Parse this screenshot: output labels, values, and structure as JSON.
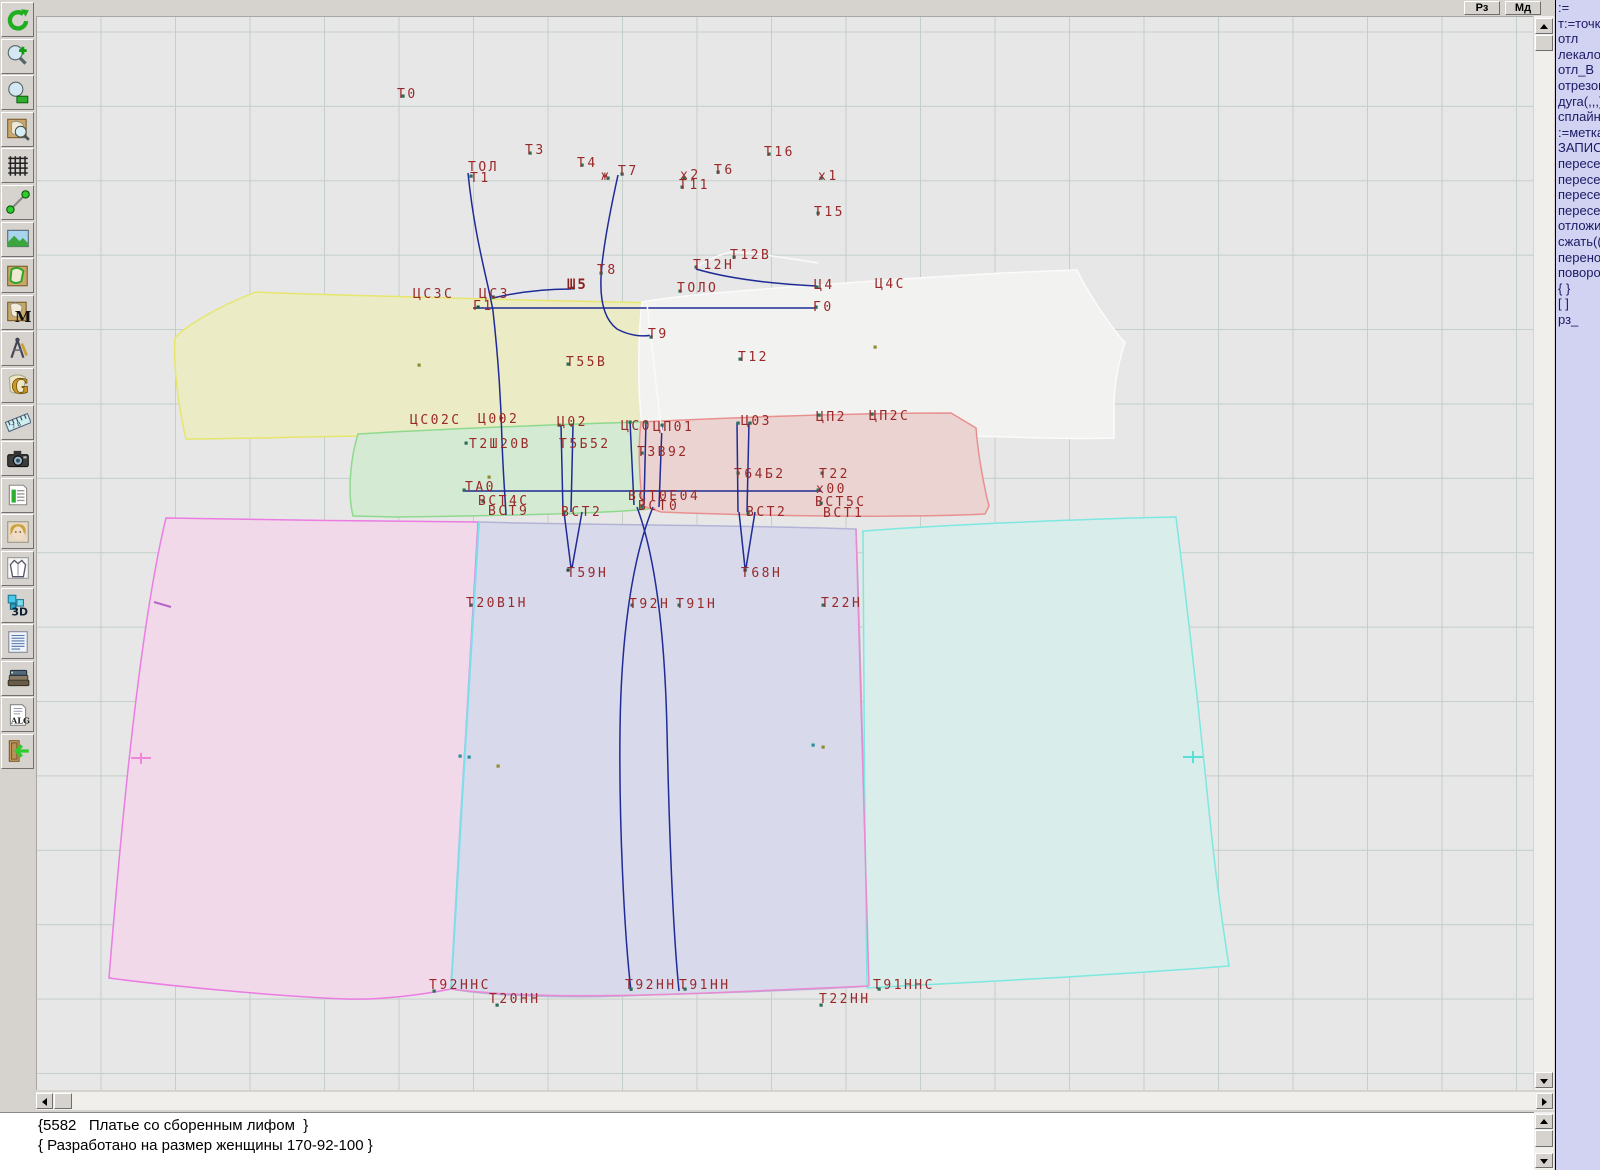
{
  "window": {
    "buttons": [
      {
        "label": "Рз"
      },
      {
        "label": "Мд"
      }
    ]
  },
  "right_panel": {
    "lines": [
      ":=",
      "т:=точка",
      "отл",
      "лекало",
      "отл_В",
      "отрезок",
      "дуга(,,,)",
      "сплайн_",
      ":=метка",
      "ЗАПИСА",
      "пересеч",
      "пересеч",
      "пересеч",
      "пересеч",
      "отложит",
      "сжать(()",
      "перенос",
      "поворот",
      "{ }",
      "[ ]",
      "рз_"
    ]
  },
  "status": {
    "line1": "{5582   Платье со сборенным лифом  }",
    "line2": "{ Разработано на размер женщины 170-92-100 }"
  },
  "toolbar": {
    "buttons": [
      {
        "name": "refresh",
        "icon": "refresh"
      },
      {
        "name": "zoom-in",
        "icon": "zoomin"
      },
      {
        "name": "zoom-out",
        "icon": "zoomout"
      },
      {
        "name": "piece-preview",
        "icon": "preview"
      },
      {
        "name": "grid",
        "icon": "grid"
      },
      {
        "name": "measure-line",
        "icon": "measure"
      },
      {
        "name": "image",
        "icon": "image"
      },
      {
        "name": "pattern-piece",
        "icon": "piece"
      },
      {
        "name": "pattern-m",
        "icon": "mletter"
      },
      {
        "name": "drafting-compass",
        "icon": "compass"
      },
      {
        "name": "letter-g",
        "icon": "gletter"
      },
      {
        "name": "ruler",
        "icon": "ruler"
      },
      {
        "name": "camera",
        "icon": "camera"
      },
      {
        "name": "size-table",
        "icon": "table"
      },
      {
        "name": "model-photo",
        "icon": "photo"
      },
      {
        "name": "garment-sketch",
        "icon": "garment"
      },
      {
        "name": "view-3d",
        "icon": "threed"
      },
      {
        "name": "text-list",
        "icon": "textlist"
      },
      {
        "name": "books",
        "icon": "books"
      },
      {
        "name": "alg-document",
        "icon": "alg"
      },
      {
        "name": "exit",
        "icon": "exit"
      }
    ]
  },
  "canvas": {
    "pieces": [
      {
        "name": "back-bodice-yellow",
        "fill": "#ebebc6",
        "stroke": "#e6e66e",
        "d": "M255,291 C290,293 380,295 450,297 C520,299 600,301 655,302 C658,330 655,380 648,427 L640,433 C580,436 460,434 360,435 C290,436 230,438 185,438 C178,410 172,365 174,337 C182,327 215,306 255,291 Z"
      },
      {
        "name": "front-bodice-white",
        "fill": "#f2f2f0",
        "stroke": "#fbfbfb",
        "d": "M641,301 C680,294 760,288 830,283 C910,277 1010,271 1076,269 C1085,288 1105,320 1124,342 C1118,358 1114,380 1113,400 L1113,437 C1060,439 960,434 860,432 C770,430 690,428 642,431 C637,400 636,345 641,301 Z"
      },
      {
        "name": "midriff-left-green",
        "fill": "#d5ead2",
        "stroke": "#8fd98f",
        "d": "M357,433 C420,429 540,424 640,421 L662,424 C660,455 653,495 648,508 C600,513 480,515 395,516 L352,515 C346,490 350,455 357,433 Z"
      },
      {
        "name": "midriff-right-red",
        "fill": "#ebd3d1",
        "stroke": "#e89090",
        "d": "M640,421 C720,417 850,412 950,412 L975,427 C977,455 984,490 988,505 L984,513 C900,517 760,515 660,511 L642,505 C638,478 637,445 640,421 Z"
      },
      {
        "name": "skirt-left-magenta",
        "fill": "#f2d9ea",
        "stroke": "#ea7ce2",
        "d": "M165,517 C260,519 380,520 477,521 L450,988 C420,994 380,999 345,998 C270,995 160,984 108,977 C115,890 135,640 165,517 Z"
      },
      {
        "name": "skirt-center-blue",
        "fill": "#d9d9ec",
        "stroke": "#b3b3d6",
        "d": "M478,521 C580,524 740,524 855,528 C860,650 864,850 868,985 C800,990 700,992 620,995 C560,997 490,995 450,988 C458,830 470,650 478,521 Z"
      },
      {
        "name": "skirt-right-cyan",
        "fill": "#d9edeb",
        "stroke": "#7ce8e0",
        "d": "M862,530 C940,524 1080,518 1175,516 C1183,580 1197,700 1207,800 C1215,880 1224,940 1228,965 C1140,972 1000,980 900,985 L866,987 C864,850 862,650 862,530 Z"
      }
    ],
    "lines": [
      {
        "d": "M478,521 C470,650 458,850 450,988",
        "stroke": "#7ce0ea",
        "w": 2
      },
      {
        "d": "M855,528 C861,700 866,870 868,985",
        "stroke": "#e98ad2",
        "w": 1.5
      },
      {
        "d": "M450,988 C520,997 620,996 730,991 C780,989 830,987 868,985",
        "stroke": "#e98ad2",
        "w": 1.5
      },
      {
        "d": "M472,307 L816,307",
        "stroke": "#1f2b96",
        "w": 1.5
      },
      {
        "d": "M462,490 L820,490",
        "stroke": "#1f2b96",
        "w": 1.5
      },
      {
        "d": "M467,172 C474,240 487,280 492,310 C497,355 500,400 501,440 C502,470 504,495 505,514",
        "stroke": "#1f2b96",
        "w": 1.5
      },
      {
        "d": "M617,174 C608,215 601,252 600,277 C599,302 604,319 616,328 C629,335 642,336 651,334",
        "stroke": "#1f2b96",
        "w": 1.5
      },
      {
        "d": "M492,297 C517,291 545,288 570,288",
        "stroke": "#1f2b96",
        "w": 1.5
      },
      {
        "d": "M695,268 C732,279 776,283 816,285",
        "stroke": "#1f2b96",
        "w": 1.5
      },
      {
        "d": "M560,424 L562,511 M572,424 L570,511 M563,511 L570,567 M581,511 L571,567",
        "stroke": "#1f2b96",
        "w": 1.5
      },
      {
        "d": "M736,421 L737,511 M748,421 L746,511 M738,511 L744,567 M754,511 L745,567",
        "stroke": "#1f2b96",
        "w": 1.5
      },
      {
        "d": "M629,420 L633,504 M645,420 L643,504 M661,424 L658,506",
        "stroke": "#1f2b96",
        "w": 1.5
      },
      {
        "d": "M652,506 C630,560 620,640 619,730 C618,820 623,930 630,990",
        "stroke": "#1f2b96",
        "w": 1.5
      },
      {
        "d": "M636,506 C656,560 664,640 666,730 C668,820 672,930 678,990",
        "stroke": "#1f2b96",
        "w": 1.5
      },
      {
        "d": "M646,303 C651,345 656,395 661,432",
        "stroke": "#fafafa",
        "w": 1.5
      },
      {
        "d": "M694,267 C706,259 719,253 731,251 C762,253 792,258 817,262",
        "stroke": "#fafafa",
        "w": 1.5
      },
      {
        "d": "M153,601 L170,606",
        "stroke": "#b565c8",
        "w": 2
      },
      {
        "d": "M130,757 L150,757 M140,752 L140,763",
        "stroke": "#ef86d8",
        "w": 2
      },
      {
        "d": "M1182,756 L1202,756 M1192,750 L1192,762",
        "stroke": "#5adfd6",
        "w": 2
      }
    ],
    "labels": [
      {
        "t": "Т0",
        "x": 396,
        "y": 87
      },
      {
        "t": "Т3",
        "x": 524,
        "y": 143
      },
      {
        "t": "Т4",
        "x": 576,
        "y": 156
      },
      {
        "t": "ТОЛ",
        "x": 467,
        "y": 160
      },
      {
        "t": "Т1",
        "x": 469,
        "y": 171
      },
      {
        "t": "ж",
        "x": 600,
        "y": 169
      },
      {
        "t": "Т7",
        "x": 617,
        "y": 164
      },
      {
        "t": "х2",
        "x": 679,
        "y": 168
      },
      {
        "t": "Т11",
        "x": 678,
        "y": 178
      },
      {
        "t": "Т6",
        "x": 713,
        "y": 163
      },
      {
        "t": "Т16",
        "x": 763,
        "y": 145
      },
      {
        "t": "х1",
        "x": 817,
        "y": 169
      },
      {
        "t": "Т15",
        "x": 813,
        "y": 205
      },
      {
        "t": "Т12В",
        "x": 729,
        "y": 248
      },
      {
        "t": "Т12Н",
        "x": 692,
        "y": 258
      },
      {
        "t": "Т8",
        "x": 596,
        "y": 263
      },
      {
        "t": "Ш5",
        "x": 566,
        "y": 278,
        "b": 1
      },
      {
        "t": "ЦСЗС",
        "x": 412,
        "y": 287
      },
      {
        "t": "ЦСЗ",
        "x": 478,
        "y": 287
      },
      {
        "t": "Г1",
        "x": 472,
        "y": 299
      },
      {
        "t": "ТОЛО",
        "x": 676,
        "y": 281
      },
      {
        "t": "Ц4",
        "x": 813,
        "y": 278
      },
      {
        "t": "Ц4С",
        "x": 874,
        "y": 277
      },
      {
        "t": "Г0",
        "x": 812,
        "y": 300
      },
      {
        "t": "Т9",
        "x": 647,
        "y": 327
      },
      {
        "t": "Т12",
        "x": 737,
        "y": 350
      },
      {
        "t": "Т55В",
        "x": 565,
        "y": 355
      },
      {
        "t": "ЦС02С",
        "x": 409,
        "y": 413
      },
      {
        "t": "Ц002",
        "x": 477,
        "y": 412
      },
      {
        "t": "Ц02",
        "x": 556,
        "y": 415
      },
      {
        "t": "ЦС0",
        "x": 620,
        "y": 419
      },
      {
        "t": "ЦП01",
        "x": 652,
        "y": 420
      },
      {
        "t": "Ц03",
        "x": 740,
        "y": 414
      },
      {
        "t": "ЦП2",
        "x": 815,
        "y": 410
      },
      {
        "t": "ЦП2С",
        "x": 868,
        "y": 409
      },
      {
        "t": "Т2Ш20В",
        "x": 468,
        "y": 437
      },
      {
        "t": "Т5Б52",
        "x": 558,
        "y": 437
      },
      {
        "t": "ТЗВ92",
        "x": 636,
        "y": 445
      },
      {
        "t": "Т64Б2",
        "x": 733,
        "y": 467
      },
      {
        "t": "Т22",
        "x": 818,
        "y": 467
      },
      {
        "t": "х00",
        "x": 815,
        "y": 482
      },
      {
        "t": "ТА0",
        "x": 464,
        "y": 480
      },
      {
        "t": "ВСТ4С",
        "x": 477,
        "y": 494
      },
      {
        "t": "ВСТ9",
        "x": 487,
        "y": 504
      },
      {
        "t": "ВСТ2",
        "x": 560,
        "y": 505
      },
      {
        "t": "ВСТ0Е04",
        "x": 627,
        "y": 489
      },
      {
        "t": "ВСТ0",
        "x": 637,
        "y": 499
      },
      {
        "t": "ВСТ2",
        "x": 745,
        "y": 505
      },
      {
        "t": "ВСТ5С",
        "x": 814,
        "y": 495
      },
      {
        "t": "ВСТ1",
        "x": 822,
        "y": 506
      },
      {
        "t": "Т59Н",
        "x": 566,
        "y": 566
      },
      {
        "t": "Т68Н",
        "x": 740,
        "y": 566
      },
      {
        "t": "Т20В1Н",
        "x": 465,
        "y": 596
      },
      {
        "t": "Т92Н",
        "x": 628,
        "y": 597
      },
      {
        "t": "Т91Н",
        "x": 675,
        "y": 597
      },
      {
        "t": "Т22Н",
        "x": 820,
        "y": 596
      },
      {
        "t": "Т92ННС",
        "x": 428,
        "y": 978
      },
      {
        "t": "Т92НН",
        "x": 624,
        "y": 978
      },
      {
        "t": "Т91НН",
        "x": 678,
        "y": 978
      },
      {
        "t": "Т91ННС",
        "x": 872,
        "y": 978
      },
      {
        "t": "Т20НН",
        "x": 488,
        "y": 992
      },
      {
        "t": "Т22НН",
        "x": 818,
        "y": 992
      }
    ],
    "points": [
      {
        "x": 402,
        "y": 95,
        "c": "#2c6e58"
      },
      {
        "x": 470,
        "y": 175,
        "c": "#2c6e58"
      },
      {
        "x": 529,
        "y": 152,
        "c": "#2c6e58"
      },
      {
        "x": 581,
        "y": 164,
        "c": "#2c6e58"
      },
      {
        "x": 621,
        "y": 173,
        "c": "#2c6e58"
      },
      {
        "x": 607,
        "y": 177,
        "c": "#2c6e58"
      },
      {
        "x": 683,
        "y": 177,
        "c": "#2c6e58"
      },
      {
        "x": 681,
        "y": 186,
        "c": "#2c6e58"
      },
      {
        "x": 717,
        "y": 171,
        "c": "#2c6e58"
      },
      {
        "x": 768,
        "y": 153,
        "c": "#2c6e58"
      },
      {
        "x": 820,
        "y": 177,
        "c": "#2c6e58"
      },
      {
        "x": 817,
        "y": 212,
        "c": "#2c6e58"
      },
      {
        "x": 733,
        "y": 256,
        "c": "#2c6e58"
      },
      {
        "x": 695,
        "y": 266,
        "c": "#2c6e58"
      },
      {
        "x": 600,
        "y": 272,
        "c": "#2c6e58"
      },
      {
        "x": 572,
        "y": 287,
        "c": "#2c6e58"
      },
      {
        "x": 492,
        "y": 296,
        "c": "#1f4f3f"
      },
      {
        "x": 477,
        "y": 306,
        "c": "#1f4f3f"
      },
      {
        "x": 679,
        "y": 290,
        "c": "#2c6e58"
      },
      {
        "x": 816,
        "y": 286,
        "c": "#2c6e58"
      },
      {
        "x": 815,
        "y": 306,
        "c": "#2c6e58"
      },
      {
        "x": 650,
        "y": 336,
        "c": "#2c6e58"
      },
      {
        "x": 739,
        "y": 358,
        "c": "#2c6e58"
      },
      {
        "x": 567,
        "y": 363,
        "c": "#2c6e58"
      },
      {
        "x": 874,
        "y": 346,
        "c": "#8e8e2e"
      },
      {
        "x": 418,
        "y": 364,
        "c": "#8e8e2e"
      },
      {
        "x": 488,
        "y": 476,
        "c": "#8e8e2e"
      },
      {
        "x": 465,
        "y": 442,
        "c": "#2c6e58"
      },
      {
        "x": 558,
        "y": 424,
        "c": "#2c6e58"
      },
      {
        "x": 571,
        "y": 424,
        "c": "#2c6e58"
      },
      {
        "x": 629,
        "y": 421,
        "c": "#2c6e58"
      },
      {
        "x": 645,
        "y": 421,
        "c": "#2c6e58"
      },
      {
        "x": 661,
        "y": 424,
        "c": "#2c6e58"
      },
      {
        "x": 737,
        "y": 422,
        "c": "#2c6e58"
      },
      {
        "x": 749,
        "y": 422,
        "c": "#2c6e58"
      },
      {
        "x": 818,
        "y": 414,
        "c": "#2c6e58"
      },
      {
        "x": 871,
        "y": 413,
        "c": "#2c6e58"
      },
      {
        "x": 641,
        "y": 452,
        "c": "#2c6e58"
      },
      {
        "x": 737,
        "y": 472,
        "c": "#2c6e58"
      },
      {
        "x": 821,
        "y": 472,
        "c": "#2c6e58"
      },
      {
        "x": 817,
        "y": 489,
        "c": "#2c6e58"
      },
      {
        "x": 463,
        "y": 489,
        "c": "#2c6e58"
      },
      {
        "x": 482,
        "y": 500,
        "c": "#2c6e58"
      },
      {
        "x": 563,
        "y": 511,
        "c": "#2c6e58"
      },
      {
        "x": 641,
        "y": 506,
        "c": "#2c6e58"
      },
      {
        "x": 747,
        "y": 512,
        "c": "#2c6e58"
      },
      {
        "x": 820,
        "y": 502,
        "c": "#2c6e58"
      },
      {
        "x": 567,
        "y": 569,
        "c": "#1f4f3f"
      },
      {
        "x": 744,
        "y": 569,
        "c": "#1f4f3f"
      },
      {
        "x": 470,
        "y": 604,
        "c": "#2c6e58"
      },
      {
        "x": 631,
        "y": 604,
        "c": "#2c6e58"
      },
      {
        "x": 678,
        "y": 604,
        "c": "#2c6e58"
      },
      {
        "x": 822,
        "y": 604,
        "c": "#2c6e58"
      },
      {
        "x": 433,
        "y": 990,
        "c": "#2c6e58"
      },
      {
        "x": 630,
        "y": 988,
        "c": "#2c6e58"
      },
      {
        "x": 684,
        "y": 988,
        "c": "#2c6e58"
      },
      {
        "x": 878,
        "y": 988,
        "c": "#2c6e58"
      },
      {
        "x": 496,
        "y": 1004,
        "c": "#2c6e58"
      },
      {
        "x": 820,
        "y": 1004,
        "c": "#2c6e58"
      },
      {
        "x": 459,
        "y": 755,
        "c": "#2a8f9f"
      },
      {
        "x": 468,
        "y": 756,
        "c": "#2a8f9f"
      },
      {
        "x": 497,
        "y": 765,
        "c": "#8e8e2e"
      },
      {
        "x": 812,
        "y": 744,
        "c": "#2a8f9f"
      },
      {
        "x": 822,
        "y": 746,
        "c": "#8e8e2e"
      }
    ]
  }
}
